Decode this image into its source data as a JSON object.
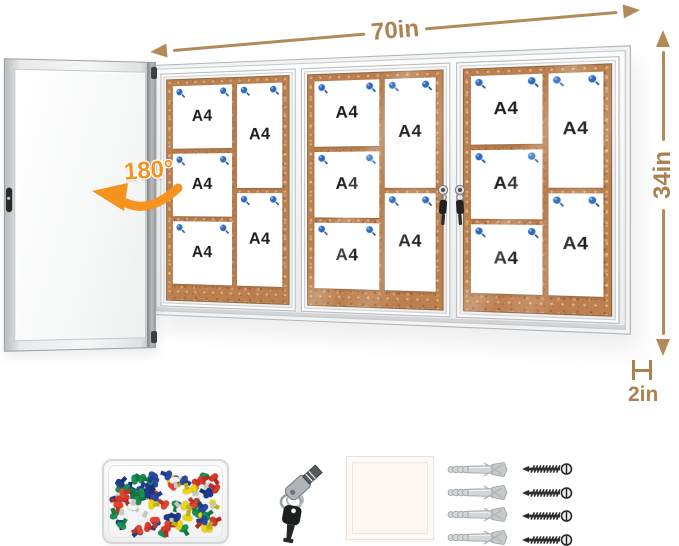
{
  "annotations": {
    "width": "70in",
    "height": "34in",
    "depth": "2in",
    "rotation": "180°",
    "dimension_color": "#ab8150",
    "rotation_color": "#f6921e"
  },
  "board": {
    "paper_label": "A4",
    "cork_color": "#bc8050",
    "frame_color": "#f2f3f4",
    "paper_pin_color": "#2b6abf",
    "sections": [
      {
        "left_papers": [
          "A4",
          "A4",
          "A4"
        ],
        "right_papers": [
          "A4",
          "A4"
        ]
      },
      {
        "left_papers": [
          "A4",
          "A4",
          "A4"
        ],
        "right_papers": [
          "A4",
          "A4"
        ]
      },
      {
        "left_papers": [
          "A4",
          "A4",
          "A4"
        ],
        "right_papers": [
          "A4",
          "A4"
        ]
      }
    ],
    "locks_count": 2
  },
  "accessories": {
    "push_pins": {
      "count": 88,
      "colors": [
        "#d8372b",
        "#2848a8",
        "#169253",
        "#ecd412",
        "#f4f4f4",
        "#1d3a8f",
        "#e0452e"
      ]
    },
    "keys_count": 2,
    "anchors_count": 4,
    "screws_count": 4
  }
}
